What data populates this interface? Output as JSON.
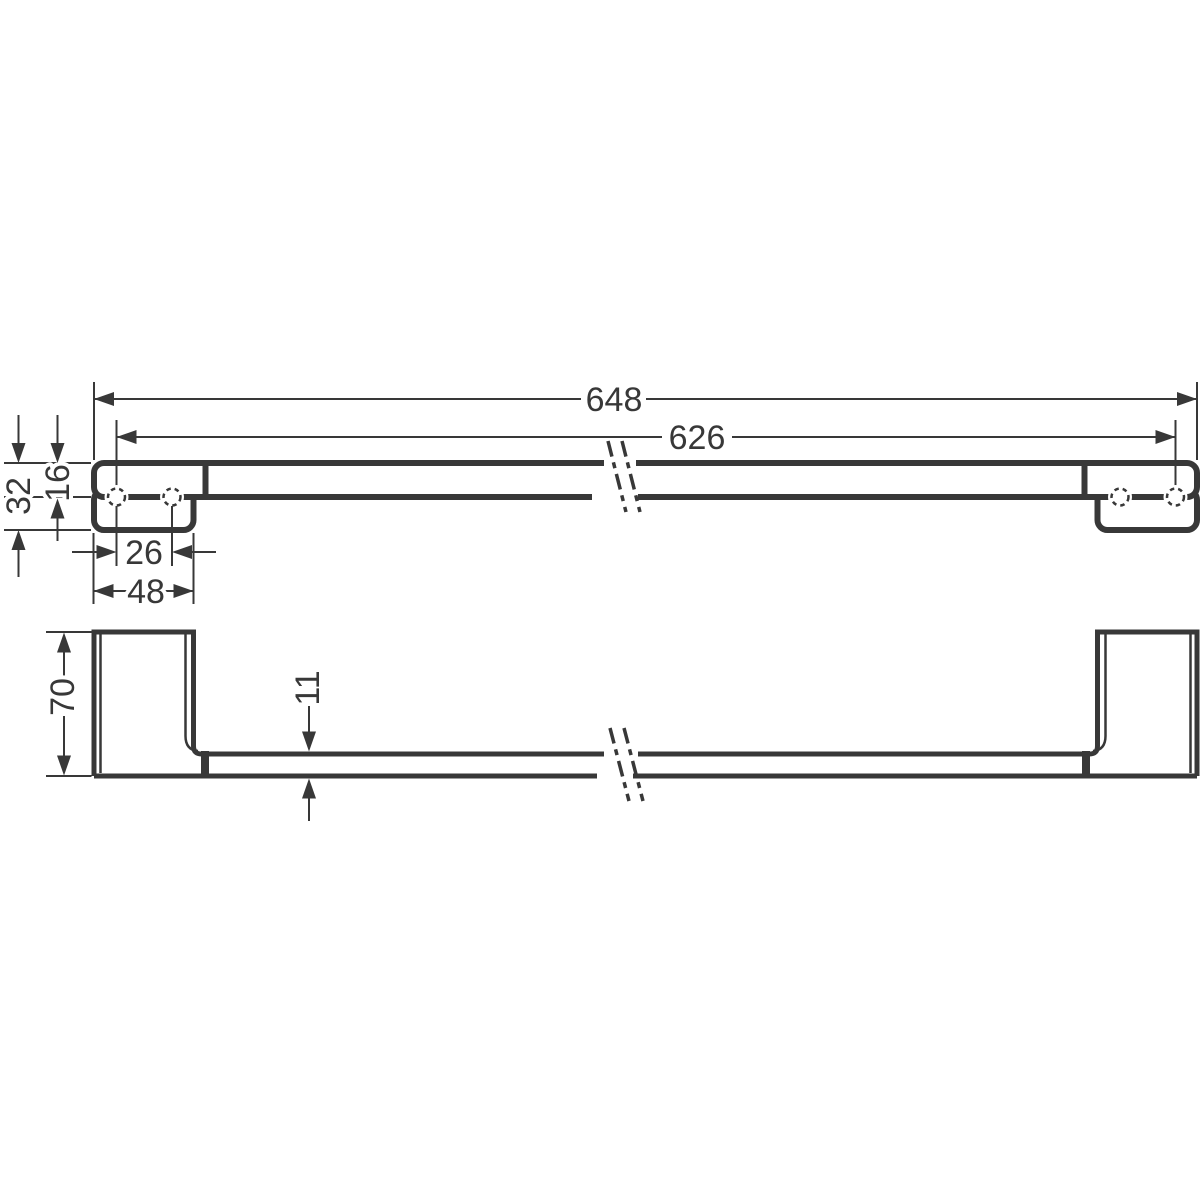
{
  "drawing": {
    "background_color": "#ffffff",
    "line_color": "#383838",
    "views": {
      "front": {
        "dims": {
          "overall_width": "648",
          "mounting_width": "626",
          "end_height": "32",
          "rail_height": "16",
          "hole_spacing": "26",
          "plate_width": "48"
        }
      },
      "plan": {
        "dims": {
          "projection": "70",
          "rail_thickness": "11"
        }
      }
    }
  }
}
